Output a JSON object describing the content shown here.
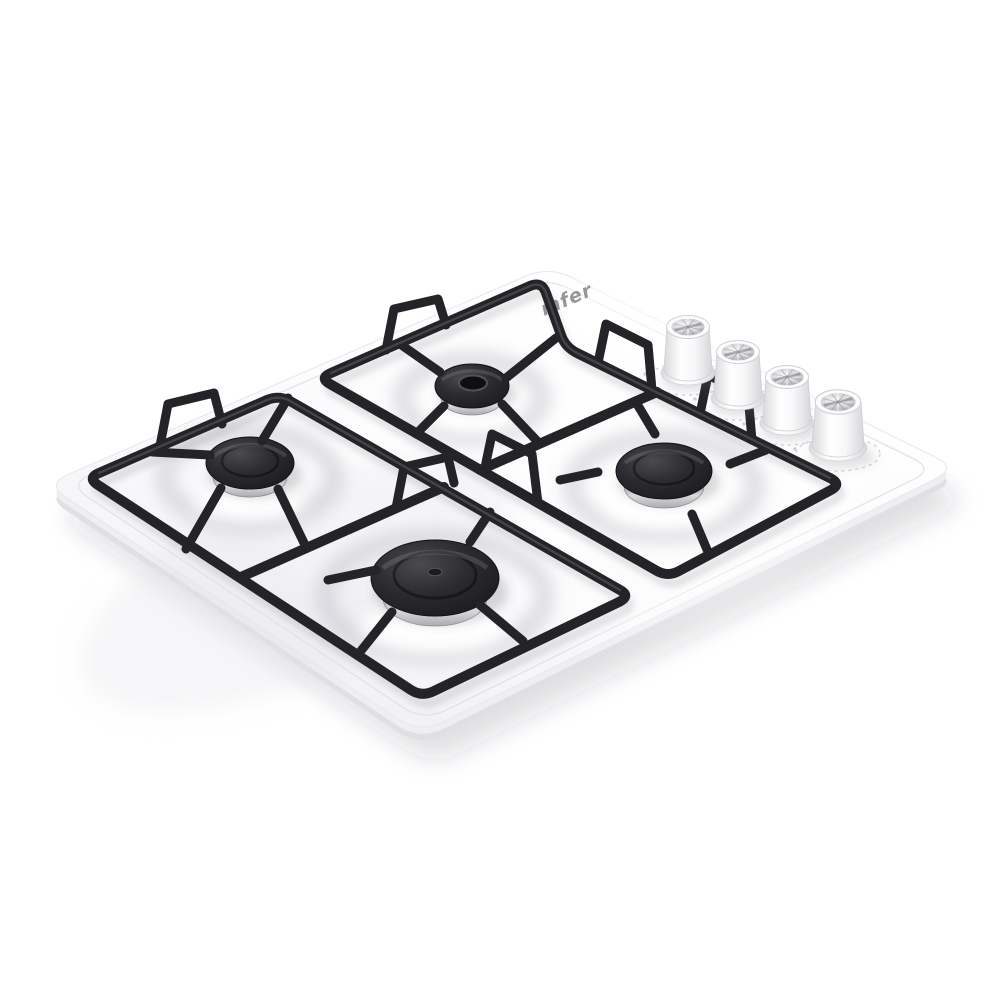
{
  "meta": {
    "description": "Product photo of a white built-in gas hob with four burners, black pan supports and four side control knobs",
    "background_color": "#ffffff"
  },
  "brand": {
    "logo_text": "mfer",
    "logo_color": "#96969a"
  },
  "hob": {
    "panel_color": "#fbfbfd",
    "panel_edge_color": "#e2e2e6",
    "grate_color": "#242428",
    "chrome_color": "#a8a9ae",
    "burners": [
      {
        "id": "rear-left",
        "size": "medium",
        "cap_color": "#2b2b2e",
        "ring_finish": "chrome"
      },
      {
        "id": "rear-right",
        "size": "small",
        "cap_color": "#2b2b2e",
        "ring_finish": "chrome"
      },
      {
        "id": "front-left",
        "size": "large",
        "cap_color": "#2b2b2e",
        "ring_finish": "chrome"
      },
      {
        "id": "front-right",
        "size": "medium",
        "cap_color": "#2b2b2e",
        "ring_finish": "chrome"
      }
    ],
    "knobs": {
      "count": 4,
      "body_color": "#ffffff",
      "top_finish": "chrome"
    }
  }
}
